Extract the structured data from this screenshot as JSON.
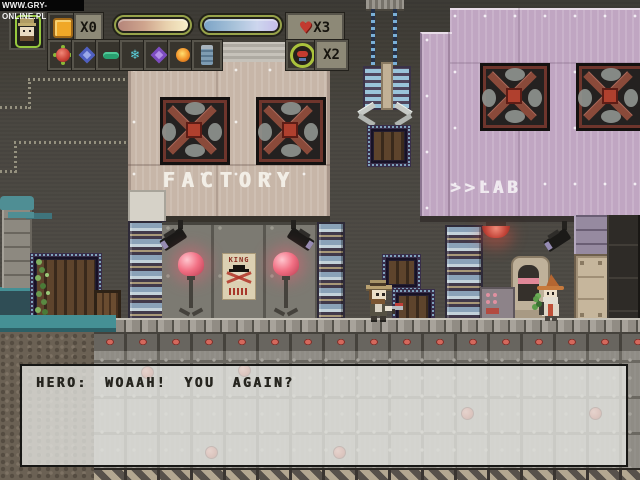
{
  "watermark": {
    "text": "WWW.GRY-ONLINE.PL"
  },
  "hud": {
    "portrait": {
      "icon": "hero-portrait"
    },
    "ammo_counter": {
      "icon": "orange-cube-icon",
      "label": "X0"
    },
    "health_bar": {
      "left_color": "#b5857a",
      "right_color": "#f6eec8"
    },
    "energy_bar": {
      "left_color": "#7ca4c6",
      "right_color": "#c6bdea"
    },
    "lives_counter": {
      "icon": "heart-icon",
      "glyph": "♥",
      "label": "X3"
    },
    "shield_counter": {
      "icon": "medal-icon",
      "label": "X2"
    },
    "item_slots": [
      {
        "icon": "red-flower-icon"
      },
      {
        "icon": "blue-gem-icon"
      },
      {
        "icon": "green-capsule-icon"
      },
      {
        "icon": "snowflake-icon",
        "glyph": "❄"
      },
      {
        "icon": "purple-gem-icon"
      },
      {
        "icon": "fire-orb-icon"
      },
      {
        "icon": "canister-icon"
      }
    ]
  },
  "scene": {
    "factory_sign": "FACTORY",
    "lab_sign": ">>LAB",
    "poster_text": "KING"
  },
  "dialogue": {
    "text": "HERO: WOAAH! YOU AGAIN?"
  },
  "colors": {
    "factory_wall": "#c7b6a8",
    "lab_wall": "#c0a6c2",
    "hud_frame_green": "#97a34a",
    "heart_red": "#c23a30",
    "lamp_pink": "#f27084",
    "alert_red": "#c65a50"
  }
}
